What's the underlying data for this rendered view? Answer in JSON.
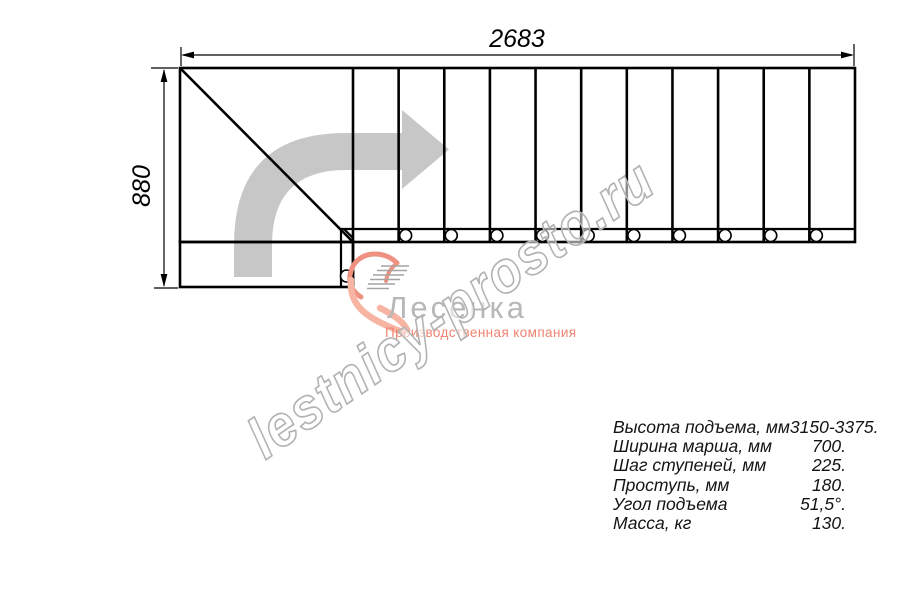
{
  "dimensions": {
    "width_label": "2683",
    "height_label": "880"
  },
  "diagram": {
    "tread_count": 11,
    "baluster_count": 10,
    "direction_arrow": "turn-right-arrow"
  },
  "watermark": {
    "text": "lestnicy-prosto.ru"
  },
  "logo": {
    "name": "Лесенка",
    "tagline": "Производственная компания"
  },
  "specs": {
    "rows": [
      {
        "label": "Высота подъема, мм",
        "value": "3150-3375."
      },
      {
        "label": "Ширина марша, мм",
        "value": "700."
      },
      {
        "label": "Шаг ступеней, мм",
        "value": "225."
      },
      {
        "label": "Проступь, мм",
        "value": "180."
      },
      {
        "label": "Угол подъема",
        "value": "51,5°."
      },
      {
        "label": "Масса, кг",
        "value": "130."
      }
    ]
  },
  "colors": {
    "line": "#000000",
    "arrow": "#c7c7c7",
    "watermark_stroke": "#b3b3b3",
    "logo_gray": "#b7b7b7",
    "logo_salmon": "#f0836f"
  }
}
